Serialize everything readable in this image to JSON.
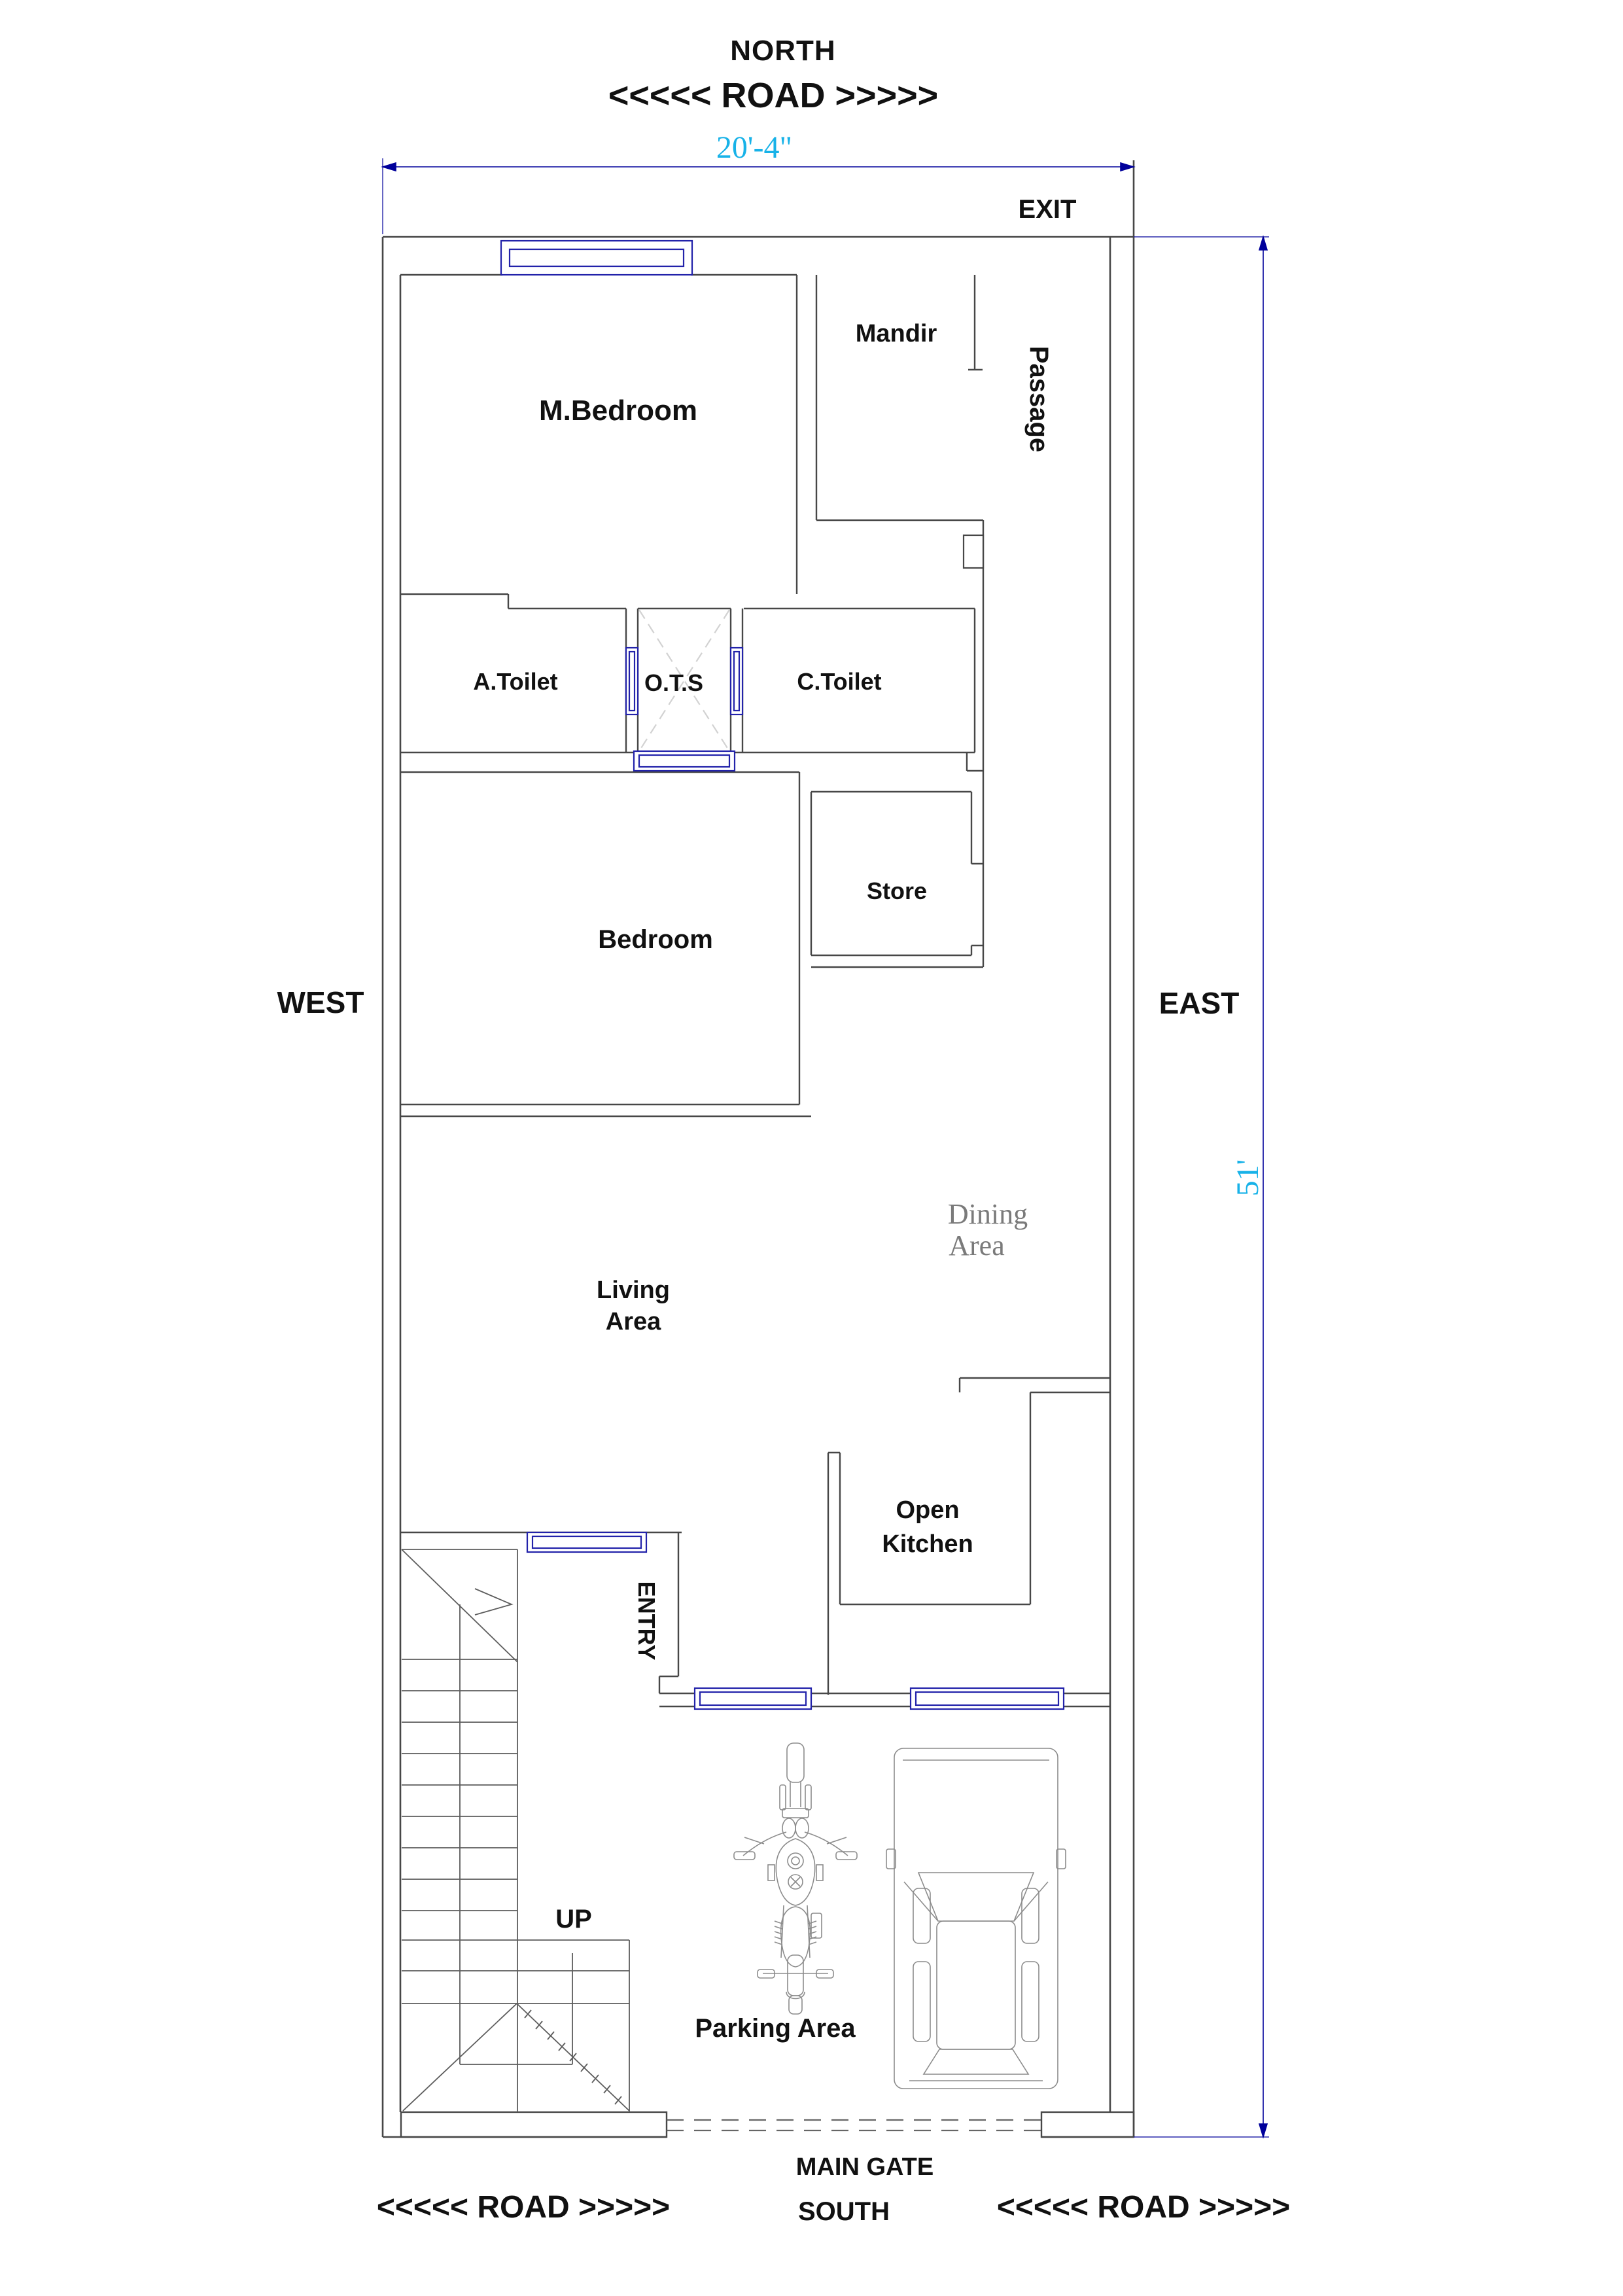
{
  "title": "House Floor Plan",
  "compass": {
    "north": "NORTH",
    "south": "SOUTH",
    "east": "EAST",
    "west": "WEST"
  },
  "roads": {
    "top": "<<<<< ROAD >>>>>",
    "bottom_left": "<<<<< ROAD >>>>>",
    "bottom_right": "<<<<< ROAD >>>>>"
  },
  "dimensions": {
    "plot_width": "20'-4\"",
    "plot_height": "51'"
  },
  "gates": {
    "exit": "EXIT",
    "main_gate": "MAIN GATE"
  },
  "rooms": {
    "m_bedroom": "M.Bedroom",
    "mandir": "Mandir",
    "passage": "Passage",
    "a_toilet": "A.Toilet",
    "ots": "O.T.S",
    "c_toilet": "C.Toilet",
    "bedroom": "Bedroom",
    "store": "Store",
    "living_line1": "Living",
    "living_line2": "Area",
    "dining_line1": "Dining",
    "dining_line2": "Area",
    "kitchen_line1": "Open",
    "kitchen_line2": "Kitchen",
    "entry": "ENTRY",
    "up": "UP",
    "parking": "Parking Area"
  },
  "icons": [
    "motorcycle-icon",
    "car-icon",
    "staircase-icon",
    "main-gate-dashes-icon"
  ],
  "colors": {
    "wall": "#474747",
    "window_frame": "#2222aa",
    "dimension_line": "#00009b",
    "dimension_text": "#17b2e8",
    "dining_text": "#7a7a7a",
    "stair_line": "#5c5c5c",
    "vehicle_line": "#8c8c8c",
    "ots_cross": "#d2d2d2",
    "label_text": "#111111",
    "background": "#ffffff"
  }
}
